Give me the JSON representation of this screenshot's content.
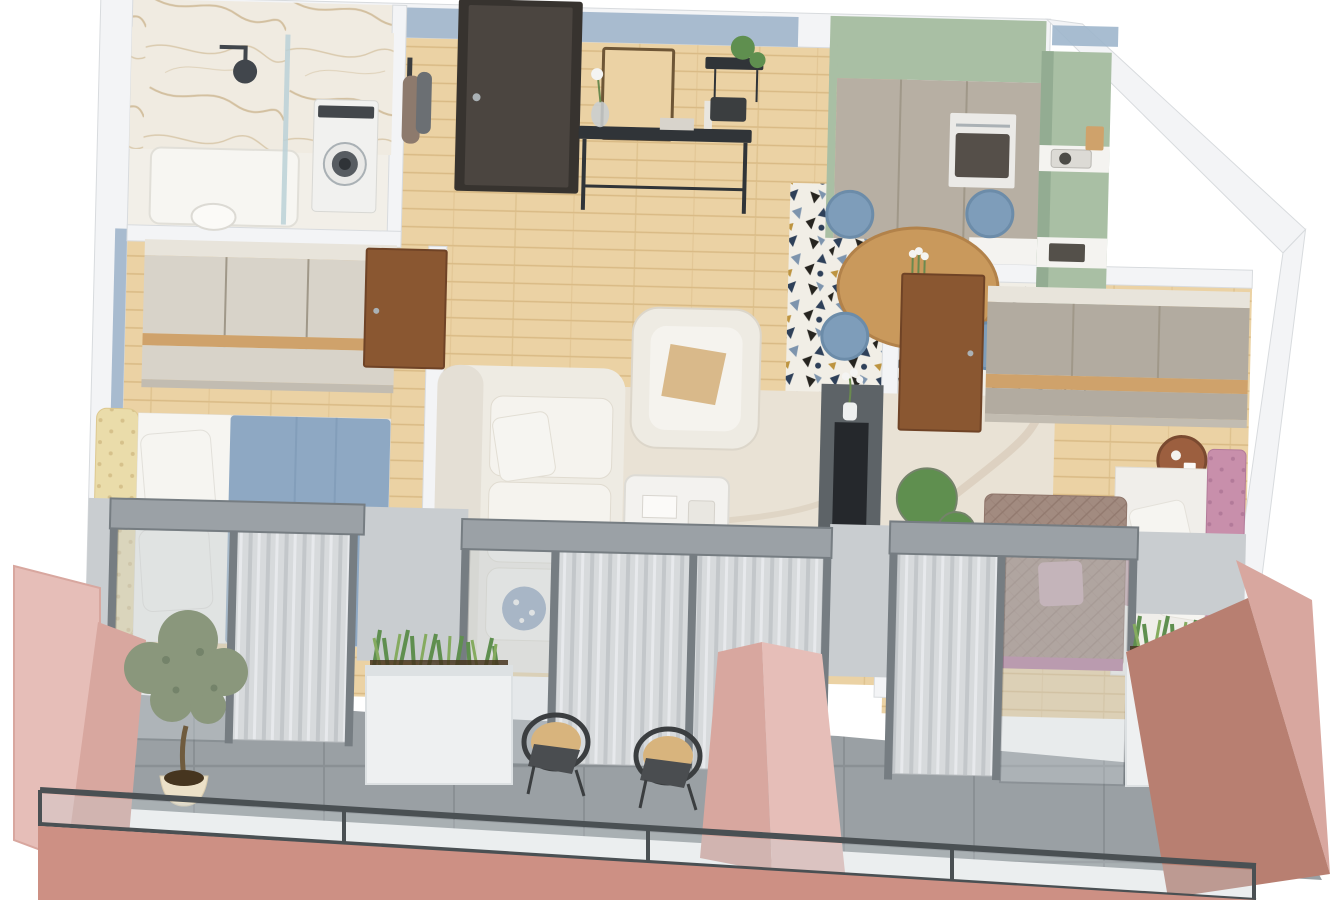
{
  "scene": {
    "type": "3d-isometric-apartment-floor-plan",
    "rooms": [
      {
        "name": "bathroom",
        "features": [
          "marble-walls",
          "walk-in-shower",
          "glass-shower-screen",
          "rain-shower-head",
          "shower-tray",
          "toilet",
          "washing-machine"
        ]
      },
      {
        "name": "entry-hall",
        "features": [
          "charcoal-front-door",
          "blue-grey-accent-wall",
          "wood-framed-mirror",
          "black-console-table",
          "vase-with-white-flower",
          "black-wall-shelf",
          "hanging-plant",
          "coat-rack-with-clothes"
        ]
      },
      {
        "name": "kitchen",
        "features": [
          "sage-green-upper-band",
          "tall-taupe-cabinets",
          "built-in-oven",
          "white-countertop",
          "sink",
          "dark-green-base-unit",
          "patterned-cement-tile-floor"
        ]
      },
      {
        "name": "dining-area",
        "features": [
          "round-wood-table",
          "tulip-vase",
          "four-blue-upholstered-chairs",
          "patterned-cement-tile-floor"
        ]
      },
      {
        "name": "bedroom-1",
        "features": [
          "cream-wardrobe-with-wood-band",
          "double-bed",
          "cream-tufted-headboard",
          "blue-duvet",
          "white-pillows",
          "walnut-door",
          "glass-balcony-door",
          "sheer-curtain"
        ]
      },
      {
        "name": "living-room",
        "features": [
          "white-fabric-sofa",
          "blue-floral-cushion",
          "white-armchair",
          "gold-cushion",
          "cream-swirl-rug",
          "white-coffee-table",
          "dark-media-wall",
          "tv-panel",
          "flower-vase",
          "monstera-plant",
          "glass-balcony-doors",
          "sheer-curtains"
        ]
      },
      {
        "name": "bedroom-2",
        "features": [
          "taupe-wardrobe-with-wood-band",
          "pink-tufted-daybed",
          "white-and-mauve-pillows",
          "quilted-taupe-sofa",
          "copper-side-table",
          "walnut-door",
          "glass-balcony-door",
          "sheer-curtain"
        ]
      },
      {
        "name": "balcony",
        "features": [
          "grey-concrete-tile-floor",
          "rose-pink-partition-walls",
          "terracotta-walls",
          "olive-tree-in-cream-pot",
          "two-white-planter-boxes",
          "snake-plant-grasses",
          "two-rattan-and-black-chairs",
          "dark-metal-glass-railing",
          "pink-fascia"
        ]
      }
    ]
  },
  "colors": {
    "bg": "#ffffff",
    "wallFace": "#f3f4f6",
    "wallShade": "#e4e7ea",
    "wallStroke": "#d8dbde",
    "pier": "#c9cdd0",
    "wallBlue": "#a8bbcf",
    "skyBlue": "#9fb6cc",
    "marbleBase": "#f0ebe1",
    "marbleVein": "#c4a97c",
    "bathFloor": "#f2efe8",
    "glassPanel": "#bcd2d8",
    "showerDark": "#41464c",
    "washerBody": "#f1f1ef",
    "washerDoor": "#575c61",
    "washerHub": "#2f3337",
    "doorCharcoal": "#4b4540",
    "doorFrame": "#37332f",
    "walnut": "#8a5731",
    "walnutEdge": "#6f4326",
    "consoleBlack": "#303438",
    "woodBase": "#ebd2a4",
    "woodLine": "#d9ba85",
    "tableWood": "#c9995c",
    "tableEdge": "#b2824a",
    "tileBase": "#f1eee6",
    "tileNavy": "#2e4059",
    "tileBlack": "#26241f",
    "tileGold": "#bd9440",
    "tileBlue": "#7d94ad",
    "sage": "#a9bfa4",
    "sageShade": "#93ac92",
    "greenDark": "#3e6049",
    "cabinetTaupe": "#b7afa3",
    "cabinetSeam": "#a09889",
    "counterWhite": "#f4f3f0",
    "ovenBody": "#ebeae7",
    "ovenGlass": "#554f49",
    "chairBlue": "#7e9dba",
    "chairBlueDark": "#6c8ca9",
    "sofaWhite": "#eeebe3",
    "sofaInner": "#f5f3ee",
    "sofaShade": "#dcd6ca",
    "rugBase": "#e9e2d5",
    "rugArc": "#d9cdbb",
    "tvDark": "#5d6367",
    "tvScreen": "#25282c",
    "headboardCream": "#eadcaa",
    "tuftCream": "#d6c18b",
    "bedBlue": "#8ea8c3",
    "bedBlueFold": "#7b97b4",
    "pillowWhite": "#f6f5f1",
    "pillowBlueFloral": "#8fa3bd",
    "pillowGold": "#d9b98a",
    "wardrobeCream": "#d8d3c9",
    "wardrobeTop": "#e8e4db",
    "wardrobeTaupe": "#b2aba0",
    "wardrobeWood": "#cfa26b",
    "wardrobeKick": "#c2bcb1",
    "bedPink": "#c88fab",
    "bedPinkDark": "#b27a99",
    "mauveSofa": "#a28b80",
    "quiltLine": "#8f756a",
    "mauvePillow": "#c2a3ab",
    "copper": "#9c5f3f",
    "balconyFloor": "#9aa0a4",
    "balconyGrout": "#8a9094",
    "pinkLight": "#e6beb8",
    "pinkMid": "#d8a79f",
    "terracotta": "#b87f71",
    "pinkFace": "#cd9084",
    "railMetal": "#4a5053",
    "frameGray": "#9ba1a6",
    "framePost": "#767d82",
    "glassTint": "#c7ced2",
    "curtain": "#d7dadc",
    "curtainFold": "#c3c7ca",
    "curtainHi": "#e9ecee",
    "planterWhite": "#eef0f1",
    "planterShade": "#dde1e3",
    "plantGreen": "#5f8f4f",
    "plantLight": "#85ab5f",
    "olive": "#8a977c",
    "oliveDark": "#74836a",
    "potCream": "#ece1c8",
    "trunk": "#6f5b3e",
    "soil": "#46351f",
    "rattan": "#d8b47d",
    "chairFrame": "#3b3e40",
    "flowerWhite": "#f4f4f2",
    "stemGreen": "#6a8a4f",
    "steel": "#aab1b5"
  }
}
